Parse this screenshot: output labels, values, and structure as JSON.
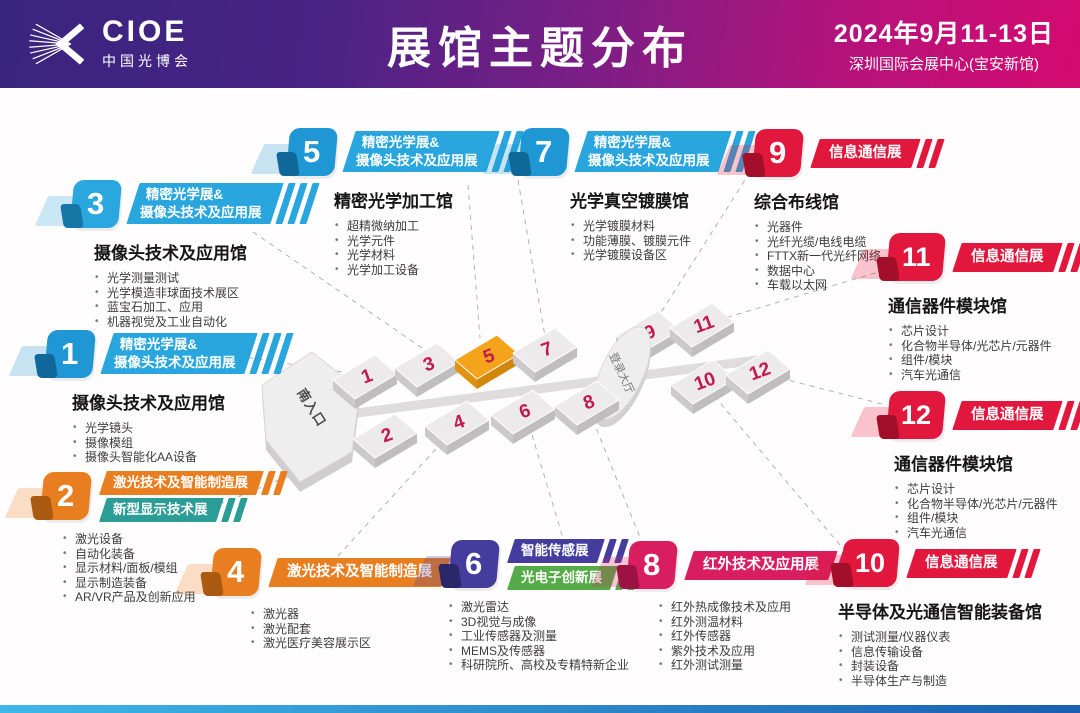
{
  "header": {
    "logo_text": "CIOE",
    "logo_subtext": "中国光博会",
    "title": "展馆主题分布",
    "date_line": "2024年9月11-13日",
    "venue_line": "深圳国际会展中心(宝安新馆)"
  },
  "map": {
    "south_entrance": "南入口",
    "lobby": "登录大厅",
    "highlight_hall": "5",
    "number_color": "#c21850",
    "halls": [
      "1",
      "3",
      "5",
      "7",
      "9",
      "11",
      "2",
      "4",
      "6",
      "8",
      "10",
      "12"
    ]
  },
  "sections": [
    {
      "no": "1",
      "badge": "#1e97d4",
      "dark": "#10679a",
      "lines": [
        {
          "t": "精密光学展&",
          "c": "#29a6dd"
        },
        {
          "t": "摄像头技术及应用展",
          "c": "#29a6dd"
        }
      ],
      "hall": "摄像头技术及应用馆",
      "items": [
        "光学镜头",
        "摄像模组",
        "摄像头智能化AA设备"
      ]
    },
    {
      "no": "2",
      "badge": "#e87e20",
      "dark": "#ab5a12",
      "lines": [
        {
          "t": "激光技术及智能制造展",
          "c": "#e87e20"
        },
        {
          "t": "新型显示技术展",
          "c": "#2b9c96"
        }
      ],
      "hall": "",
      "items": [
        "激光设备",
        "自动化装备",
        "显示材料/面板/模组",
        "显示制造装备",
        "AR/VR产品及创新应用"
      ]
    },
    {
      "no": "3",
      "badge": "#2aa7de",
      "dark": "#1677a6",
      "lines": [
        {
          "t": "精密光学展&",
          "c": "#29a6dd"
        },
        {
          "t": "摄像头技术及应用展",
          "c": "#29a6dd"
        }
      ],
      "hall": "摄像头技术及应用馆",
      "items": [
        "光学测量测试",
        "光学模造非球面技术展区",
        "蓝宝石加工、应用",
        "机器视觉及工业自动化"
      ]
    },
    {
      "no": "4",
      "badge": "#e87e20",
      "dark": "#ab5a12",
      "lines": [
        {
          "t": "激光技术及智能制造展",
          "c": "#e87e20"
        }
      ],
      "hall": "",
      "items": [
        "激光器",
        "激光配套",
        "激光医疗美容展示区"
      ]
    },
    {
      "no": "5",
      "badge": "#1e97d4",
      "dark": "#10679a",
      "lines": [
        {
          "t": "精密光学展&",
          "c": "#29a6dd"
        },
        {
          "t": "摄像头技术及应用展",
          "c": "#29a6dd"
        }
      ],
      "hall": "精密光学加工馆",
      "items": [
        "超精微纳加工",
        "光学元件",
        "光学材料",
        "光学加工设备"
      ]
    },
    {
      "no": "6",
      "badge": "#443d9e",
      "dark": "#2c2768",
      "lines": [
        {
          "t": "智能传感展",
          "c": "#443d9e"
        },
        {
          "t": "光电子创新展",
          "c": "#55ab47"
        }
      ],
      "hall": "",
      "items": [
        "激光雷达",
        "3D视觉与成像",
        "工业传感器及测量",
        "MEMS及传感器",
        "科研院所、高校及专精特新企业"
      ]
    },
    {
      "no": "7",
      "badge": "#1e97d4",
      "dark": "#10679a",
      "lines": [
        {
          "t": "精密光学展&",
          "c": "#29a6dd"
        },
        {
          "t": "摄像头技术及应用展",
          "c": "#29a6dd"
        }
      ],
      "hall": "光学真空镀膜馆",
      "items": [
        "光学镀膜材料",
        "功能薄膜、镀膜元件",
        "光学镀膜设备区"
      ]
    },
    {
      "no": "8",
      "badge": "#d81e5f",
      "dark": "#9c1343",
      "lines": [
        {
          "t": "红外技术及应用展",
          "c": "#d81e5f"
        }
      ],
      "hall": "",
      "items": [
        "红外热成像技术及应用",
        "红外测温材料",
        "红外传感器",
        "紫外技术及应用",
        "红外测试测量"
      ]
    },
    {
      "no": "9",
      "badge": "#e2173d",
      "dark": "#a30e2a",
      "lines": [
        {
          "t": "信息通信展",
          "c": "#e2173d"
        }
      ],
      "hall": "综合布线馆",
      "items": [
        "光器件",
        "光纤光缆/电线电缆",
        "FTTX新一代光纤网络",
        "数据中心",
        "车载以太网"
      ]
    },
    {
      "no": "10",
      "badge": "#e2173d",
      "dark": "#a30e2a",
      "lines": [
        {
          "t": "信息通信展",
          "c": "#e2173d"
        }
      ],
      "hall": "半导体及光通信智能装备馆",
      "items": [
        "测试测量/仪器仪表",
        "信息传输设备",
        "封装设备",
        "半导体生产与制造"
      ]
    },
    {
      "no": "11",
      "badge": "#e2173d",
      "dark": "#a30e2a",
      "lines": [
        {
          "t": "信息通信展",
          "c": "#e2173d"
        }
      ],
      "hall": "通信器件模块馆",
      "items": [
        "芯片设计",
        "化合物半导体/光芯片/元器件",
        "组件/模块",
        "汽车光通信"
      ]
    },
    {
      "no": "12",
      "badge": "#e2173d",
      "dark": "#a30e2a",
      "lines": [
        {
          "t": "信息通信展",
          "c": "#e2173d"
        }
      ],
      "hall": "通信器件模块馆",
      "items": [
        "芯片设计",
        "化合物半导体/光芯片/元器件",
        "组件/模块",
        "汽车光通信"
      ]
    }
  ]
}
